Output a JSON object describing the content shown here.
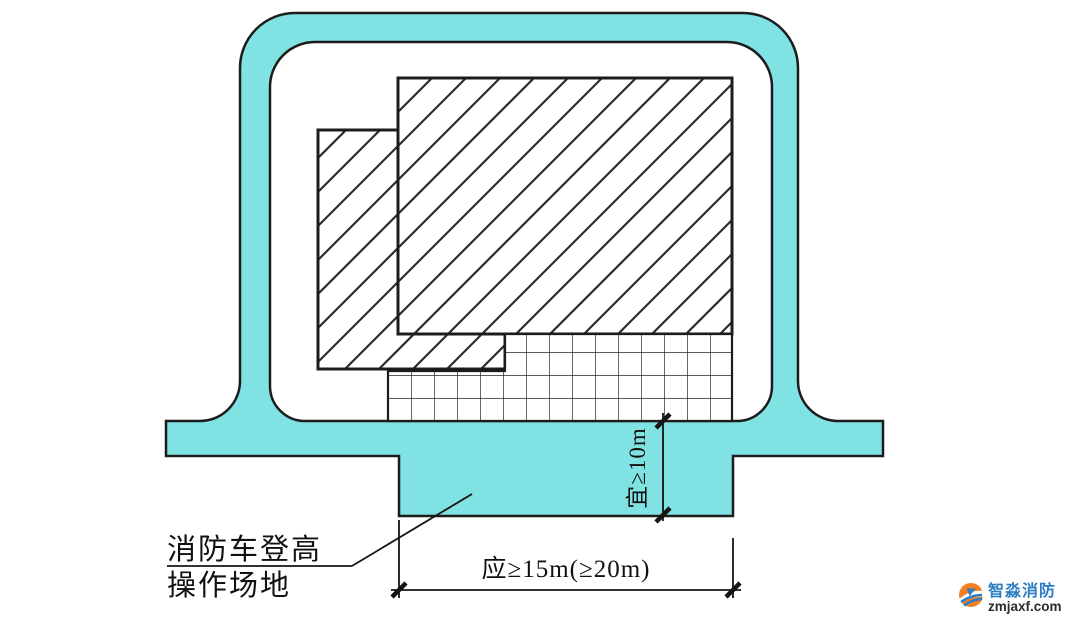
{
  "diagram": {
    "type": "fire-truck-access-site-plan",
    "site_label": {
      "line1": "消防车登高",
      "line2": "操作场地"
    },
    "dimensions": {
      "horizontal": "应≥15m(≥20m)",
      "vertical": "宜≥10m"
    },
    "features": {
      "ring_road": "perimeter fire lane loop",
      "operation_site_bump": "fire truck high-reach operation site",
      "high_rise_building": "diagonal-hatched building",
      "podium_building": "diagonal-hatched lower building",
      "gridded_zone": "grid-hatched operation strip"
    }
  },
  "colors": {
    "road_fill": "#80e2e2",
    "outline": "#1c1c1c",
    "hatch": "#2b2b2b",
    "grid": "#262626",
    "dimension": "#141414"
  },
  "watermark": {
    "brand_name": "智淼消防",
    "brand_domain": "zmjaxf.com",
    "brand_color": "#2e7cc4",
    "domain_color": "#2b2b2b",
    "logo_orange": "#f08021"
  }
}
